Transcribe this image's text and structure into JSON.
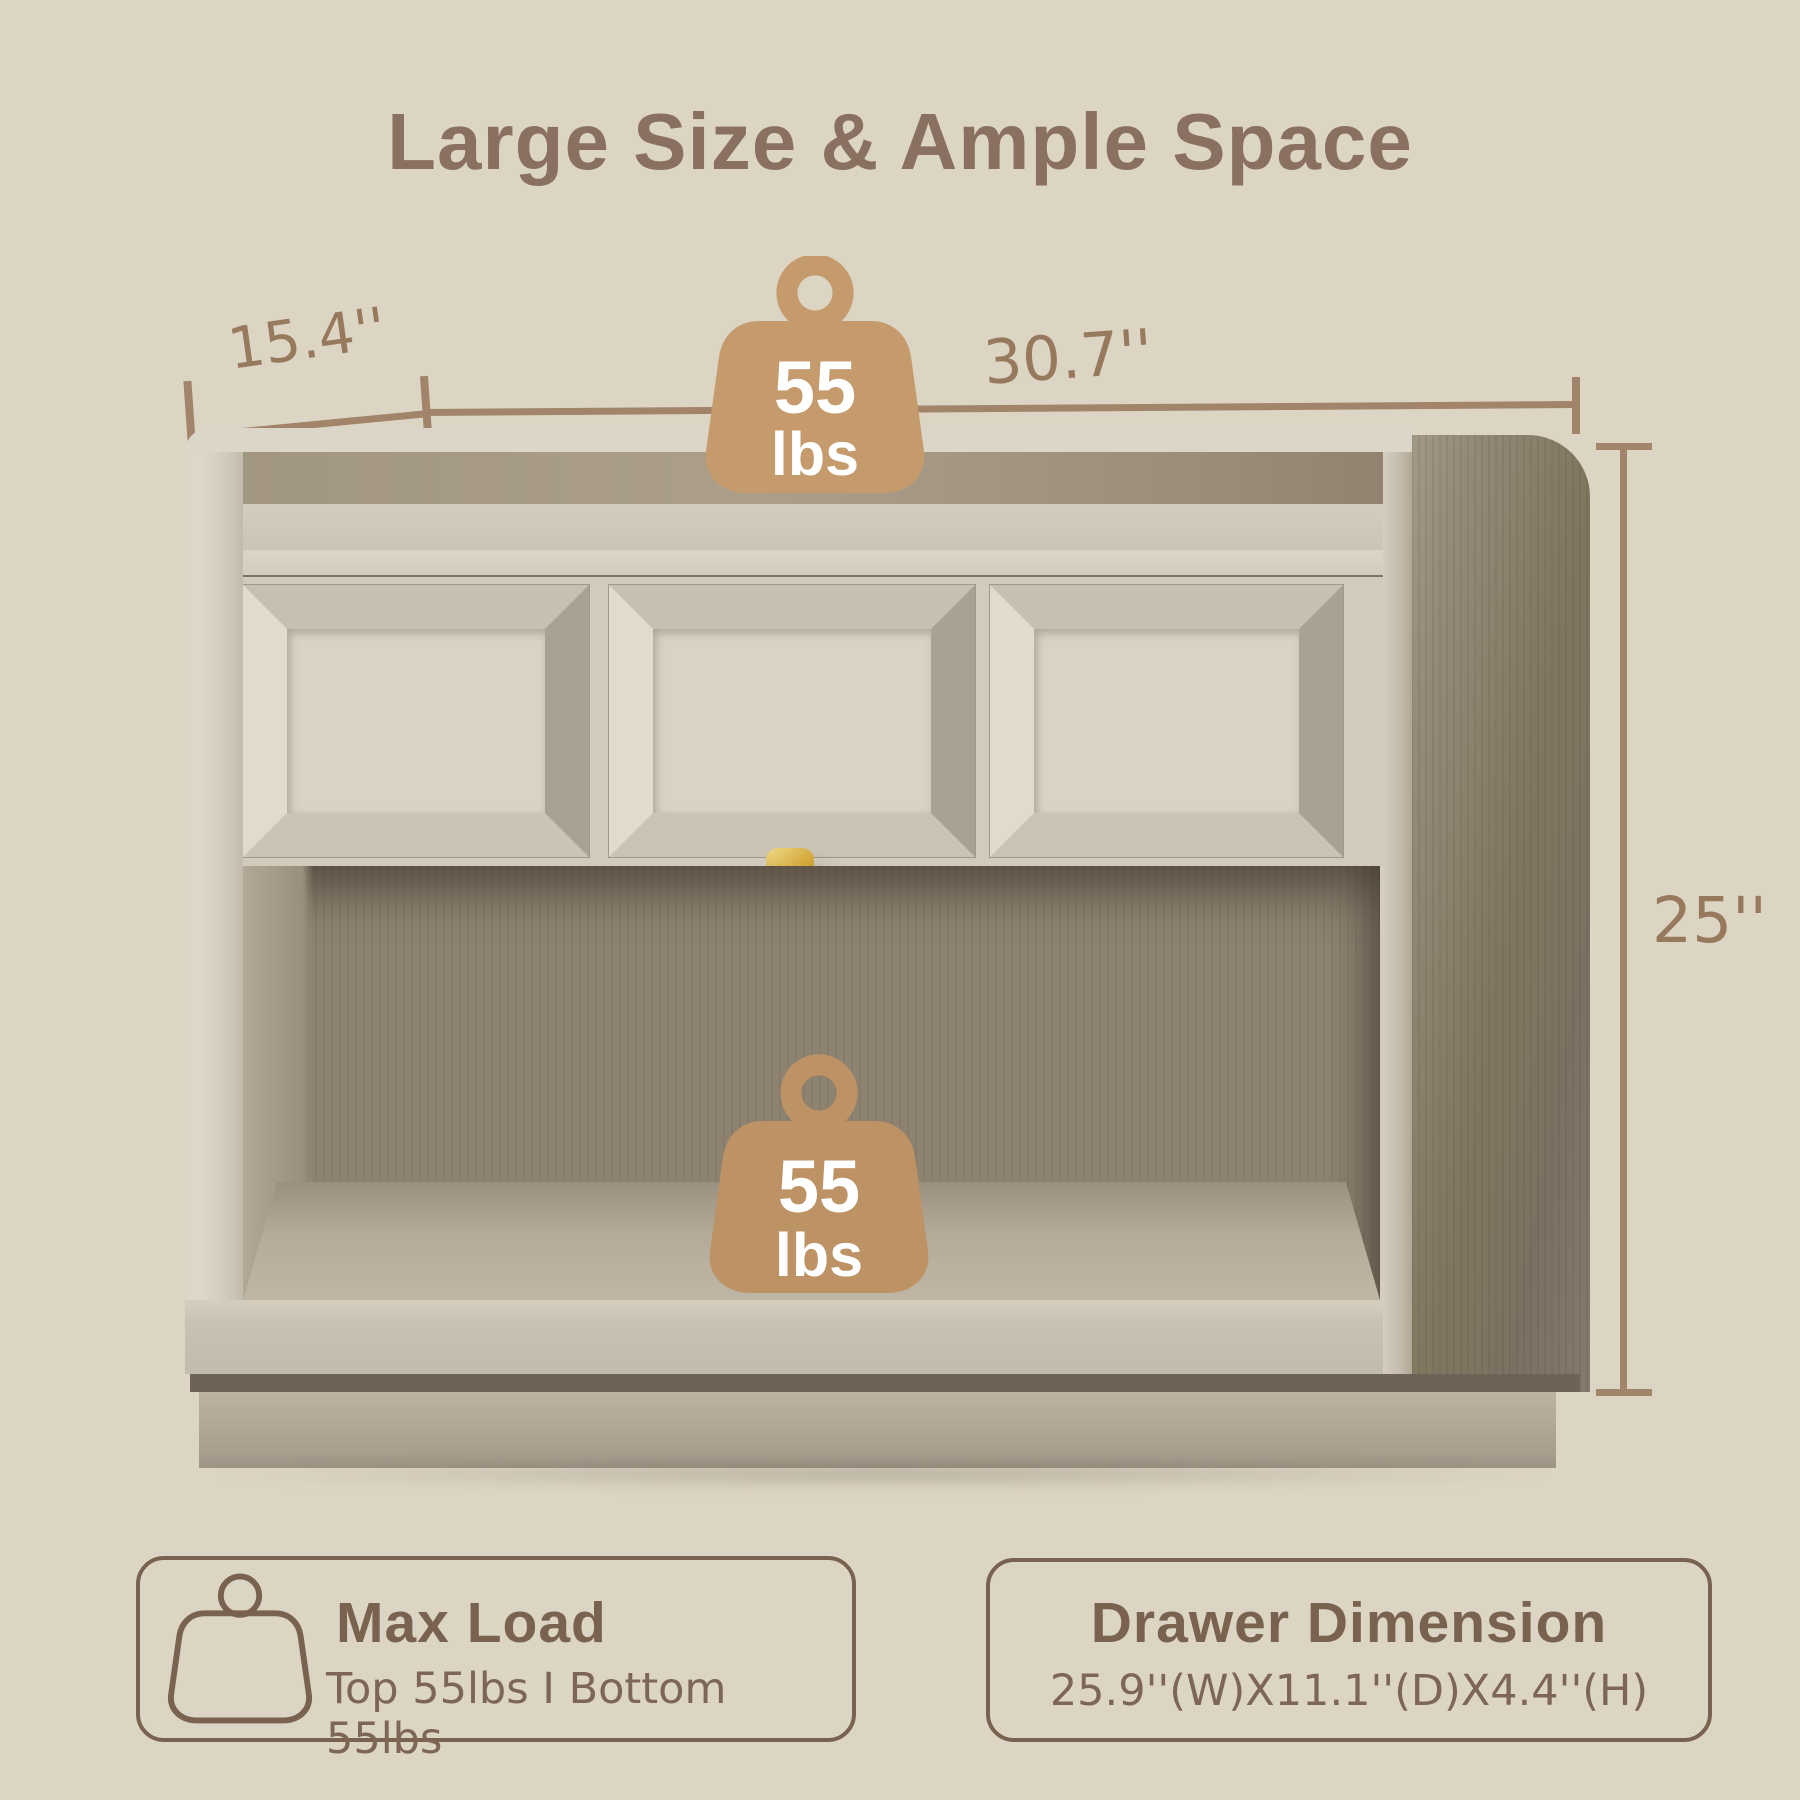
{
  "title": "Large Size & Ample Space",
  "dimensions": {
    "side_width": "15.4''",
    "front_width": "30.7''",
    "height": "25''"
  },
  "load_badges": {
    "top": {
      "value": "55",
      "unit": "lbs"
    },
    "bottom": {
      "value": "55",
      "unit": "lbs"
    }
  },
  "cards": [
    {
      "title": "Max Load",
      "subtitle": "Top 55lbs I Bottom 55lbs"
    },
    {
      "title": "Drawer Dimension",
      "subtitle": "25.9''(W)X11.1''(D)X4.4''(H)"
    }
  ],
  "colors": {
    "background": "#ddd5c3",
    "title_text": "#8a7061",
    "dimension_line": "#a1846a",
    "dimension_text": "#97795e",
    "badge_fill": "#c59b6d",
    "badge_text": "#ffffff",
    "card_border": "#7a6250",
    "knob_gold": "#d4a93c"
  }
}
